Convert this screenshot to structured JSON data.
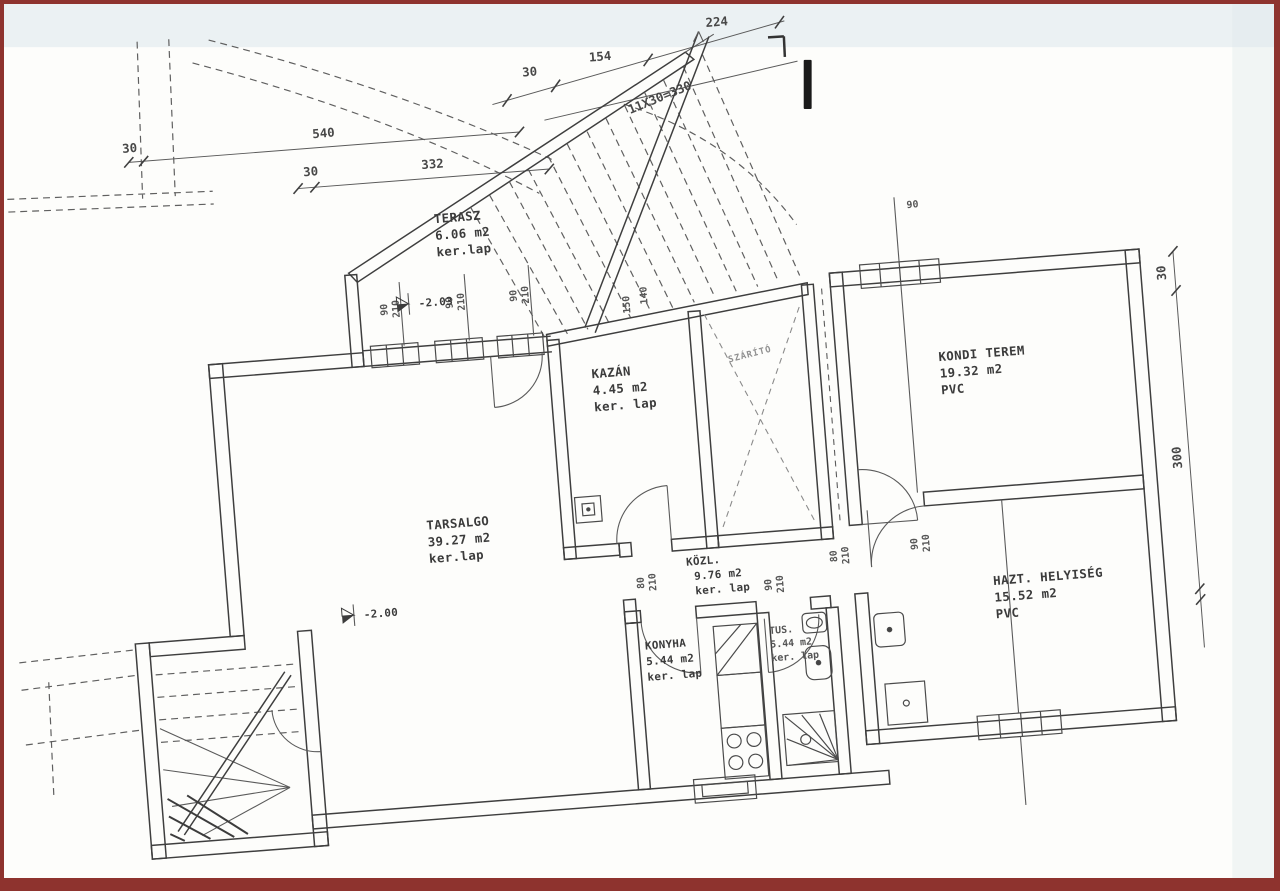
{
  "plan": {
    "rooms": [
      {
        "id": "terasz",
        "name": "TERASZ",
        "area": "6.06 m2",
        "floor": "ker.lap"
      },
      {
        "id": "kazan",
        "name": "KAZÁN",
        "area": "4.45 m2",
        "floor": "ker. lap"
      },
      {
        "id": "szarito",
        "name": "SZÁRÍTÓ",
        "area": "",
        "floor": ""
      },
      {
        "id": "kondi",
        "name": "KONDI TEREM",
        "area": "19.32 m2",
        "floor": "PVC"
      },
      {
        "id": "tarsalgo",
        "name": "TARSALGO",
        "area": "39.27 m2",
        "floor": "ker.lap"
      },
      {
        "id": "kozl",
        "name": "KÖZL.",
        "area": "9.76 m2",
        "floor": "ker. lap"
      },
      {
        "id": "konyha",
        "name": "KONYHA",
        "area": "5.44 m2",
        "floor": "ker. lap"
      },
      {
        "id": "tus",
        "name": "TUS.",
        "area": "5.44 m2",
        "floor": "ker. lap"
      },
      {
        "id": "hazt",
        "name": "HAZT. HELYISÉG",
        "area": "15.52 m2",
        "floor": "PVC"
      }
    ],
    "elevations": {
      "terasz": "-2.03",
      "tarsalgo": "-2.00"
    },
    "dims_top": {
      "d30a": "30",
      "d540": "540",
      "d30b": "30",
      "d332": "332",
      "d30c": "30",
      "d154": "154",
      "d224": "224"
    },
    "stair_note": "11X30=330",
    "stair_marks": {
      "m150": "150",
      "m140": "140"
    },
    "dims_right": {
      "d30": "30",
      "d300": "300"
    },
    "window_mark": "90",
    "door_dims": [
      {
        "w": "90",
        "h": "210"
      },
      {
        "w": "90",
        "h": "210"
      },
      {
        "w": "90",
        "h": "210"
      },
      {
        "w": "80",
        "h": "210"
      },
      {
        "w": "90",
        "h": "210"
      },
      {
        "w": "80",
        "h": "210"
      },
      {
        "w": "90",
        "h": "210"
      }
    ],
    "border_color": "#8e332e"
  }
}
